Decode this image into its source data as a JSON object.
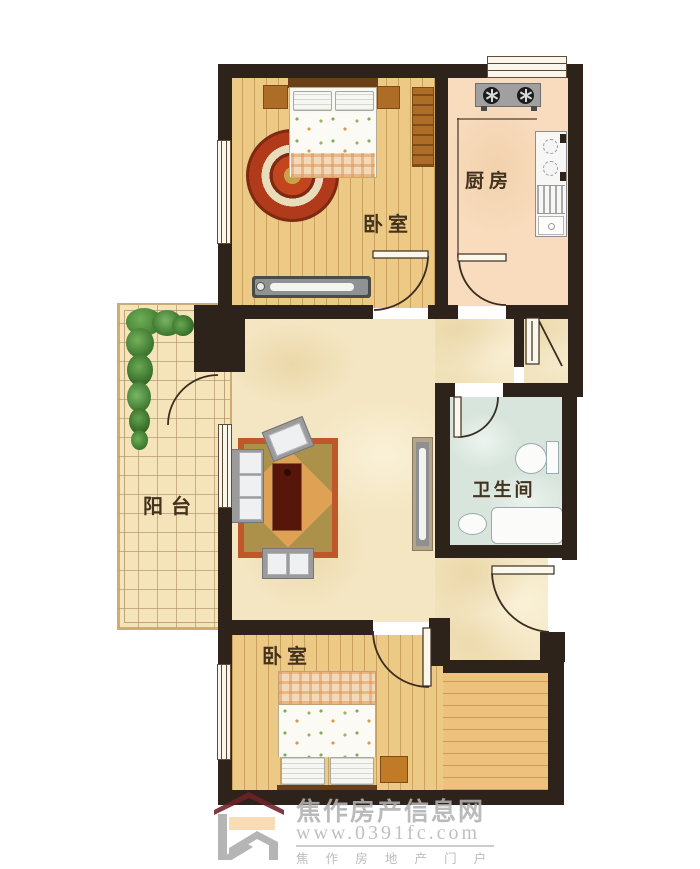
{
  "rooms": [
    {
      "id": "bedroom-top",
      "label": "卧室"
    },
    {
      "id": "kitchen",
      "label": "厨房"
    },
    {
      "id": "balcony",
      "label": "阳台"
    },
    {
      "id": "bathroom",
      "label": "卫生间"
    },
    {
      "id": "bedroom-bottom",
      "label": "卧室"
    }
  ],
  "watermark": {
    "site_name": "焦作房产信息网",
    "url": "www.0391fc.com",
    "tagline": "焦 作 房 地 产 门 户"
  },
  "colors": {
    "wall": "#2e231a",
    "wood_floor": "#ecc985",
    "kitchen_floor": "#f8dcbd",
    "living_floor": "#f4e6c2",
    "bathroom_floor": "#d8e5dd",
    "balcony_tile": "#f5e3ba",
    "rug_red": "#c2451d",
    "furniture_wood": "#ad6d26",
    "watermark_gray": "#b2b2b2",
    "logo_red": "#6d2127"
  }
}
